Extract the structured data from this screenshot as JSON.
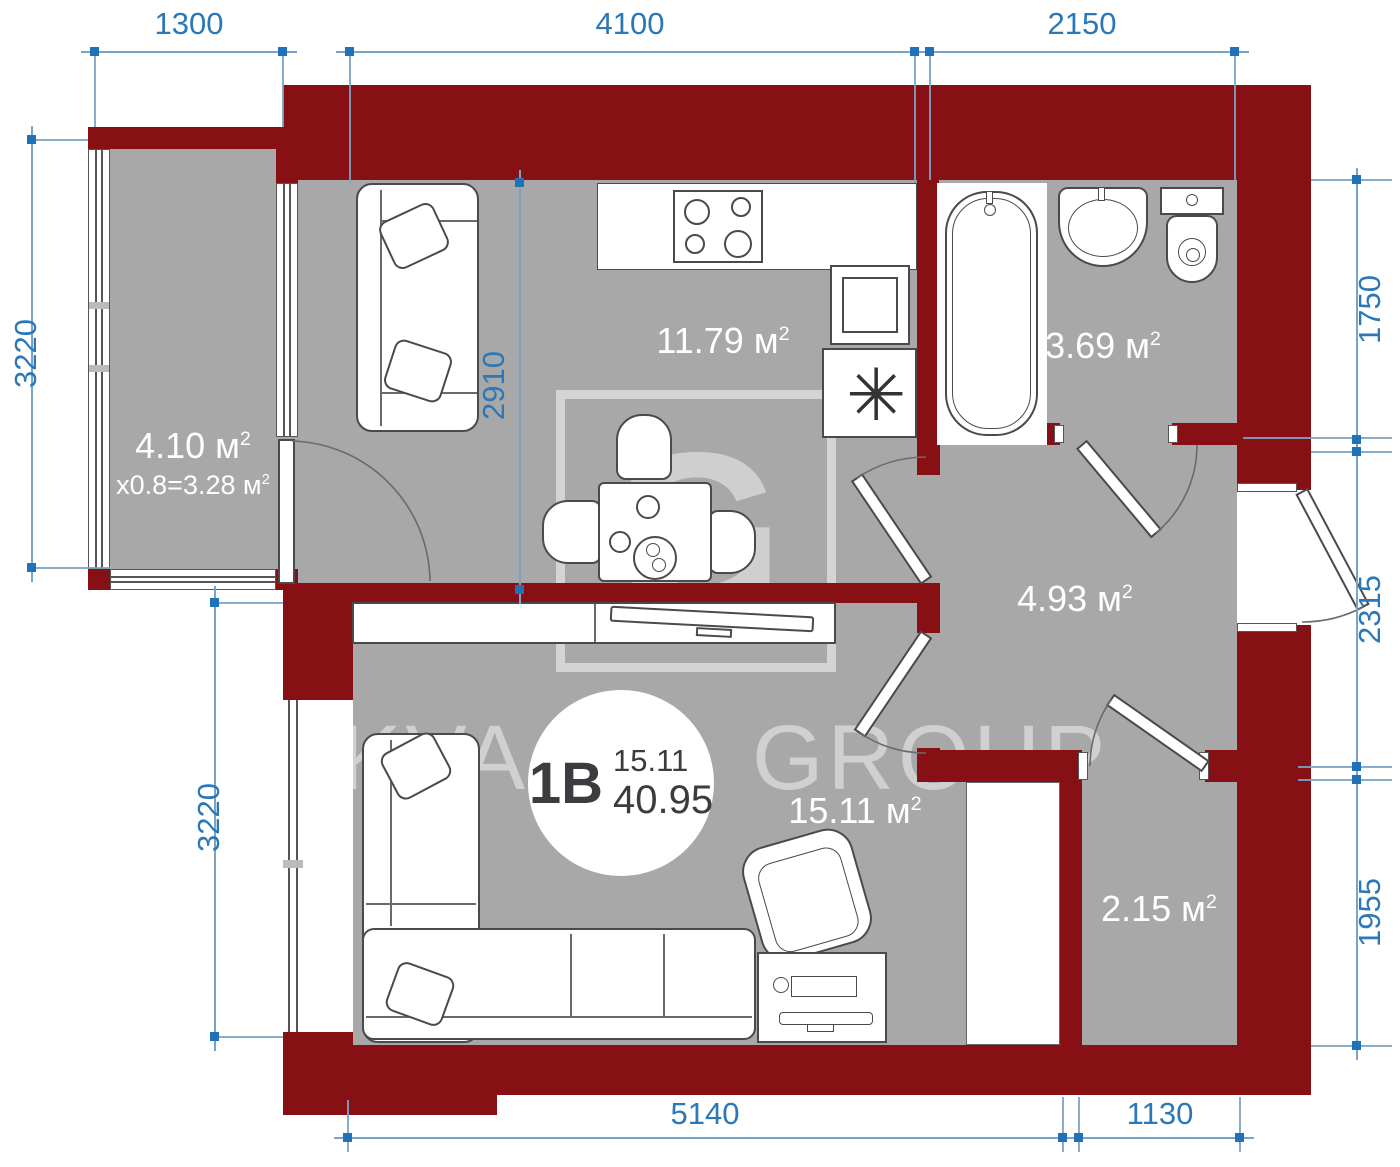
{
  "colors": {
    "wall": "#871014",
    "floor": "#a8a8a8",
    "dim": "#2b78b8",
    "dim_line": "#7ba3c6",
    "marker": "#1f72b8",
    "label": "#ffffff",
    "badge_text": "#3c3c40",
    "watermark": "#d8d8d8"
  },
  "units": {
    "area_unit": "м",
    "area_sup": "2"
  },
  "rooms": {
    "balcony": {
      "area": "4.10",
      "reduced": "x0.8=3.28"
    },
    "kitchen": {
      "area": "11.79"
    },
    "bathroom": {
      "area": "3.69"
    },
    "hallway": {
      "area": "4.93"
    },
    "living": {
      "area": "15.11"
    },
    "storage": {
      "area": "2.15"
    }
  },
  "badge": {
    "plan_type": "1B",
    "living_area": "15.11",
    "total_area": "40.95"
  },
  "watermark": {
    "left": "KVA",
    "right": "GROUP",
    "logo_letter": "G"
  },
  "dimensions": {
    "top": [
      "1300",
      "4100",
      "2150"
    ],
    "left_balcony": "3220",
    "left_room": "3220",
    "interior_kitchen": "2910",
    "right": [
      "1750",
      "2315",
      "1955"
    ],
    "bottom": [
      "5140",
      "1130"
    ]
  },
  "fixtures": {
    "boiler_symbol": "✳"
  }
}
